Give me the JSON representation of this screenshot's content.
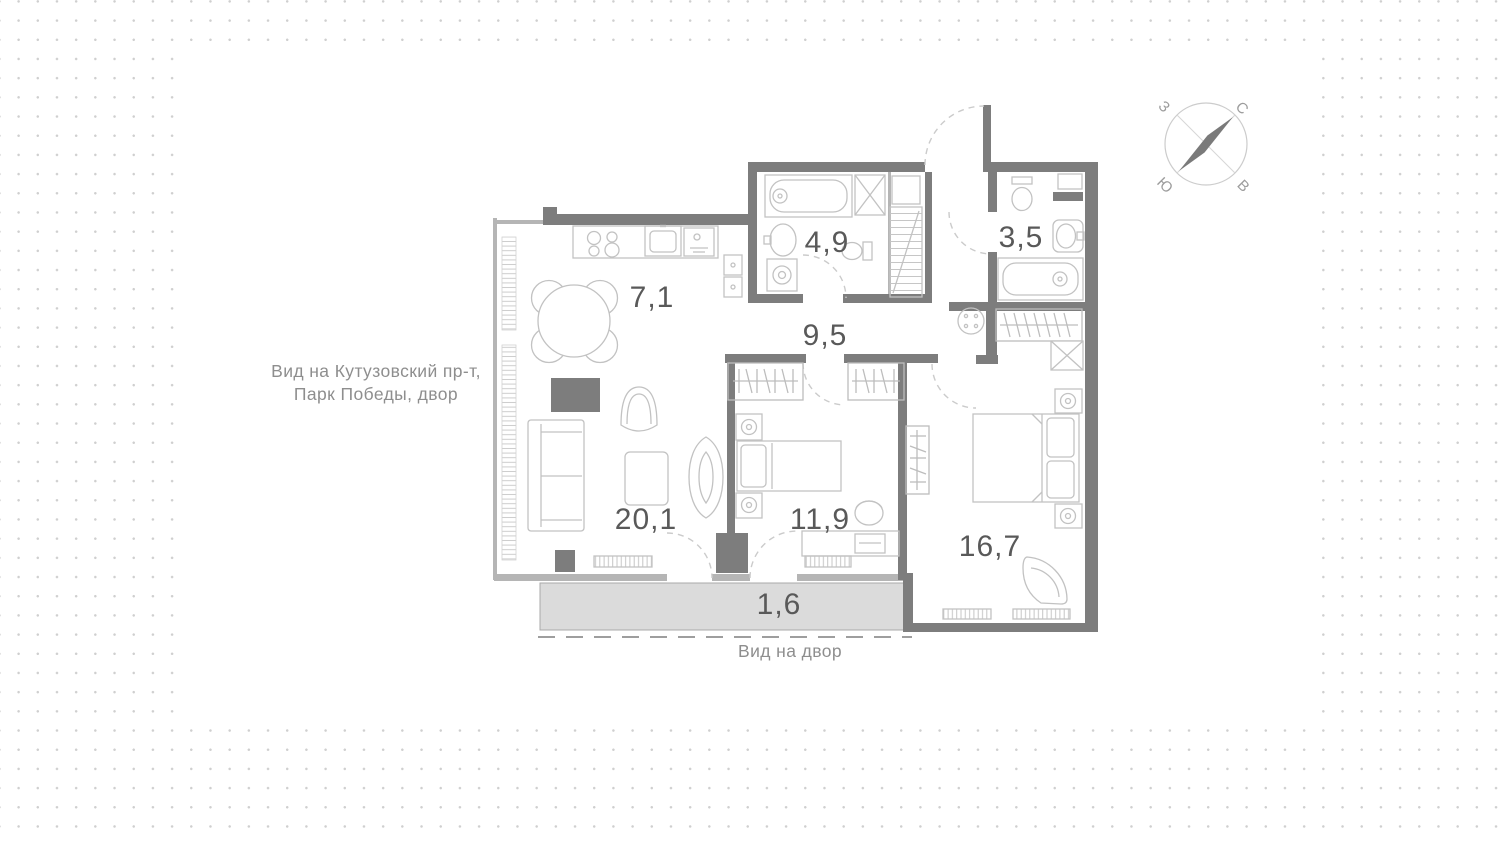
{
  "plan": {
    "areas": {
      "kitchen": "7,1",
      "bathroom_big": "4,9",
      "bathroom_small": "3,5",
      "hallway": "9,5",
      "living_room": "20,1",
      "bedroom_small": "11,9",
      "bedroom_master": "16,7",
      "balcony": "1,6"
    },
    "views": {
      "left_line1": "Вид на Кутузовский пр-т,",
      "left_line2": "Парк Победы, двор",
      "bottom": "Вид на двор"
    },
    "compass": {
      "north": "С",
      "east": "В",
      "south": "Ю",
      "west": "З"
    },
    "colors": {
      "wall": "#7d7d7d",
      "furniture": "#c2c2c2",
      "balcony_fill": "#dbdbdb",
      "room_label": "#595959",
      "view_label": "#8e8e8e",
      "dot_grid": "#cfcfcf"
    }
  }
}
